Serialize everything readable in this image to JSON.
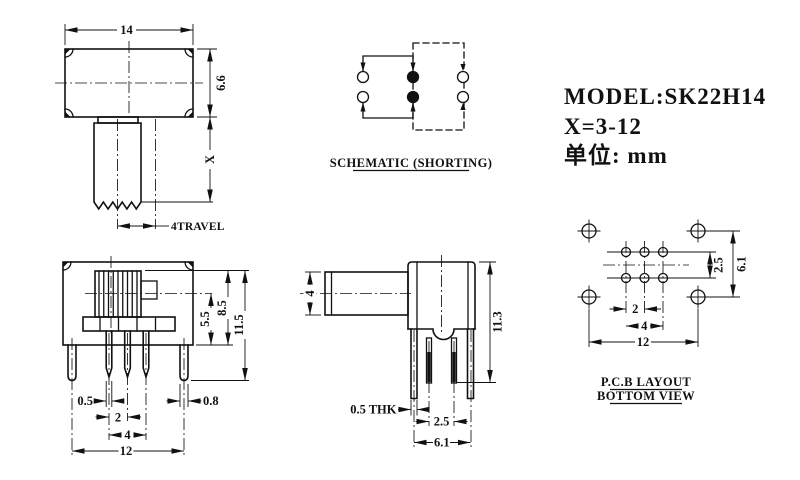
{
  "drawing": {
    "title_block": {
      "model": "MODEL:SK22H14",
      "range": "X=3-12",
      "unit": "单位: mm"
    },
    "top_view": {
      "dim_width": "14",
      "dim_height": "6.6",
      "dim_shaft": "X",
      "dim_travel": "4TRAVEL"
    },
    "schematic": {
      "caption": "SCHEMATIC (SHORTING)"
    },
    "front_view": {
      "dim_pin_width": "0.5",
      "dim_pin_pitch": "2",
      "dim_pin_span": "4",
      "dim_peg_span": "12",
      "dim_peg_width": "0.8",
      "dim_center_height": "5.5",
      "dim_body_height": "8.5",
      "dim_total_height": "11.5"
    },
    "side_view": {
      "dim_shaft": "4",
      "dim_total_height": "11.3",
      "dim_thickness": "0.5 THK",
      "dim_row_pitch": "2.5",
      "dim_outer_span": "6.1"
    },
    "pcb_layout": {
      "dim_row_pitch": "2.5",
      "dim_row_span": "6.1",
      "dim_pad_pitch": "2",
      "dim_pad_span": "4",
      "dim_hole_span": "12",
      "caption_line1": "P.C.B LAYOUT",
      "caption_line2": "BOTTOM VIEW"
    },
    "ink": "#111111",
    "background": "#ffffff"
  }
}
